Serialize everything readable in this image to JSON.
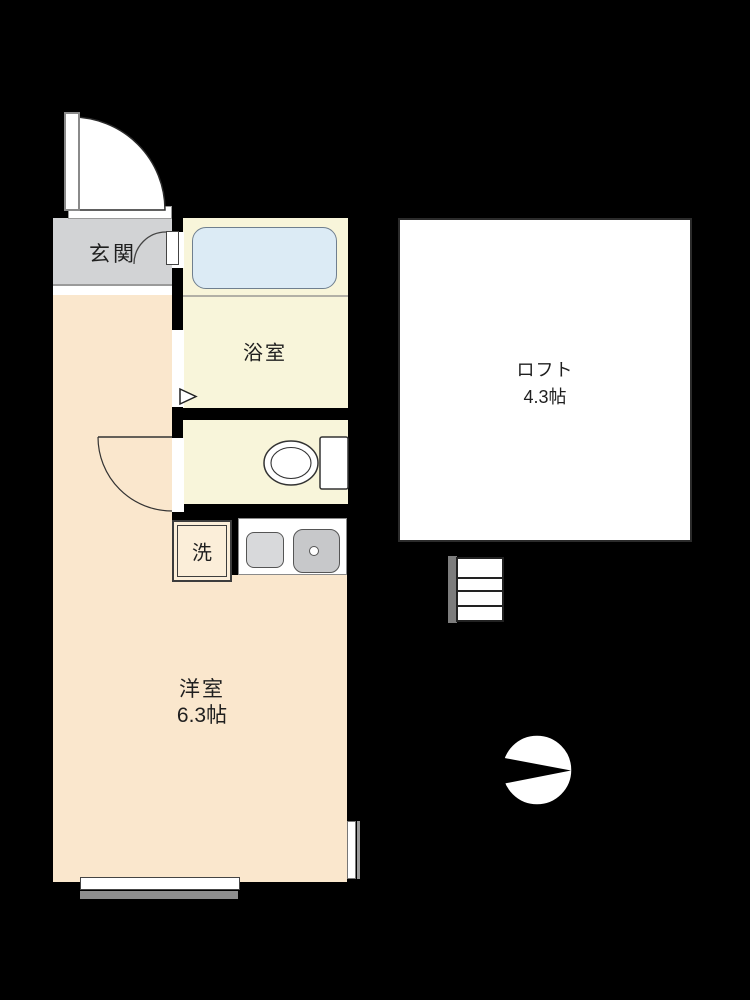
{
  "rooms": {
    "entrance": {
      "label": "玄関"
    },
    "bathroom": {
      "label": "浴室"
    },
    "western_room": {
      "label": "洋室",
      "size": "6.3帖"
    },
    "loft": {
      "label": "ロフト",
      "size": "4.3帖"
    },
    "laundry": {
      "label": "洗"
    }
  },
  "compass": {
    "pointing": "right"
  },
  "colors": {
    "background": "#000000",
    "room-peach": "#fae7cd",
    "room-cream": "#f8f5da",
    "genkan-gray": "#d2d3d5",
    "tub-blue": "#dcebf5",
    "counter-white": "#ffffff",
    "sink-gray": "#d8d9db",
    "stove-gray": "#c7c8ca",
    "stair-gray": "#7d7d7d",
    "balcony-gray": "#8e8e8e",
    "line-dark": "#2b2b2b",
    "text": "#1f1f1f"
  }
}
